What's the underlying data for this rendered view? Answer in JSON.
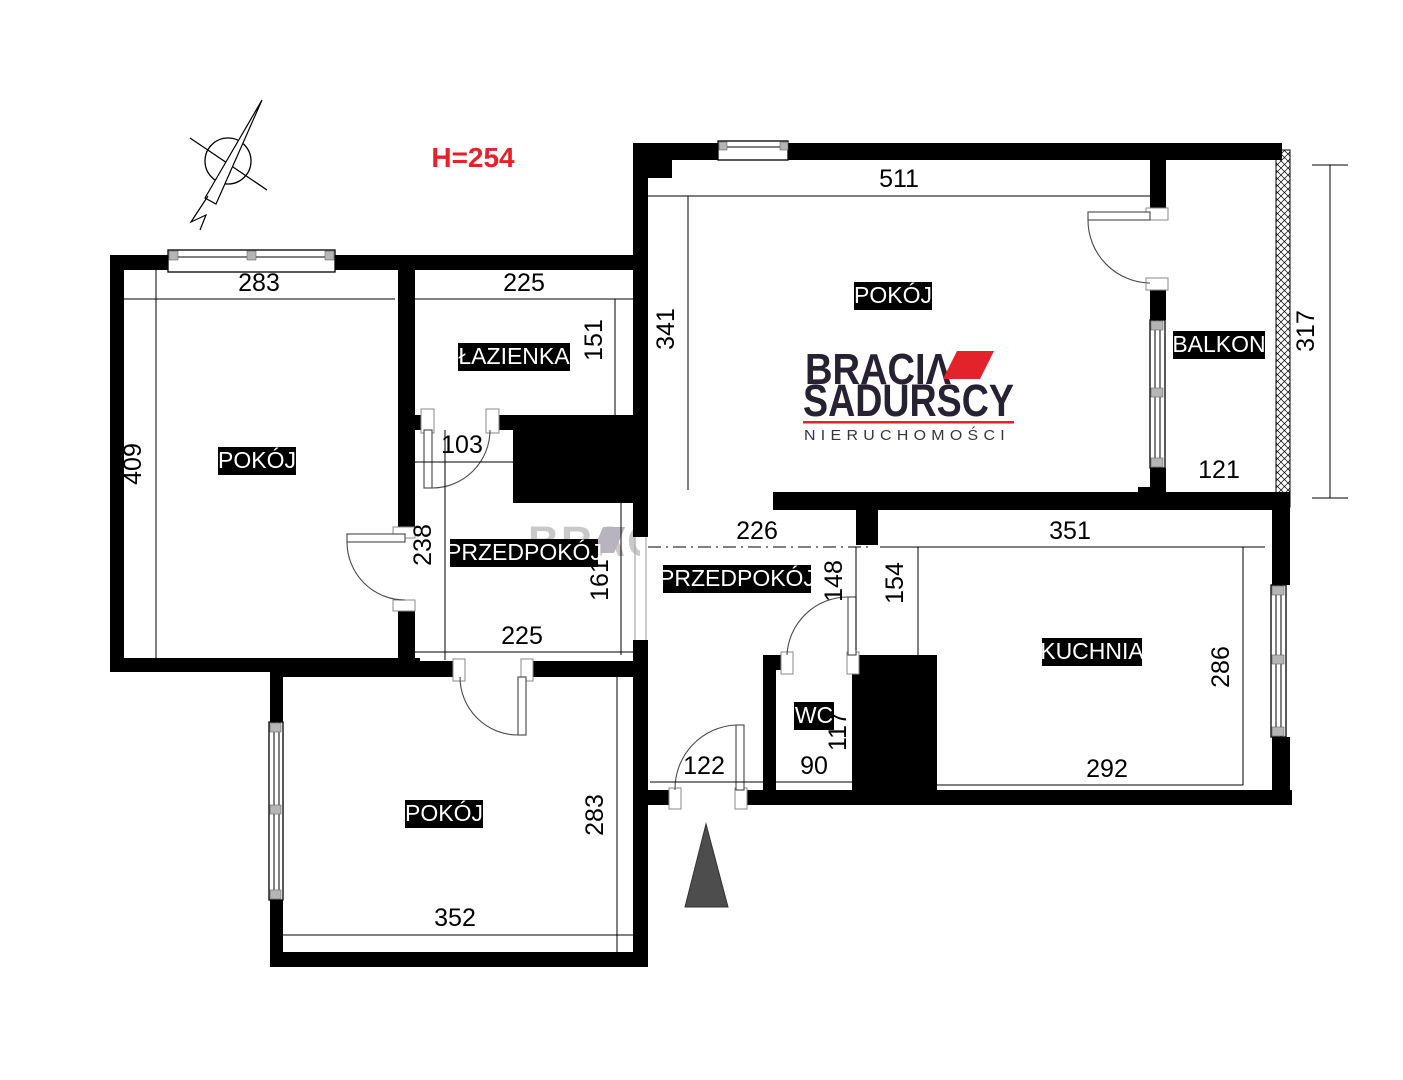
{
  "colors": {
    "wall": "#000000",
    "accent_red": "#e3222a",
    "logo_navy": "#272231",
    "logo_sub": "#38333f",
    "arrow_gray": "#4d4d4d",
    "watermark_gray": "#c9c9c9",
    "watermark_mark": "#b7b4c0"
  },
  "ceiling_height": "H=254",
  "watermark": {
    "text": "BRACIΛ"
  },
  "logo": {
    "line1": "BRACIΛ",
    "line2": "SADURSCY",
    "line3": "NIERUCHOMOŚCI"
  },
  "rooms": {
    "room_top_right": "POKÓJ",
    "room_left": "POKÓJ",
    "room_bottom": "POKÓJ",
    "bathroom": "ŁAZIENKA",
    "hallway_left": "PRZEDPOKÓJ",
    "hallway_middle": "PRZEDPOKÓJ",
    "kitchen": "KUCHNIA",
    "wc": "WC",
    "balcony": "BALKON"
  },
  "dims": {
    "room_left_width": "283",
    "room_left_height": "409",
    "bathroom_width": "225",
    "bathroom_height": "151",
    "bathroom_door": "103",
    "hallway_left_height_upper": "238",
    "hallway_left_height_lower": "161",
    "hallway_left_width": "225",
    "room_top_right_width": "511",
    "room_top_right_height": "341",
    "hallway_middle_width": "226",
    "hallway_middle_height": "148",
    "kitchen_entry_height": "154",
    "kitchen_width_top": "351",
    "kitchen_height": "286",
    "kitchen_width_bottom": "292",
    "balcony_width": "121",
    "balcony_height": "317",
    "wc_height": "117",
    "wc_width": "90",
    "entry_door_width": "122",
    "room_bottom_width": "352",
    "room_bottom_height": "283"
  }
}
